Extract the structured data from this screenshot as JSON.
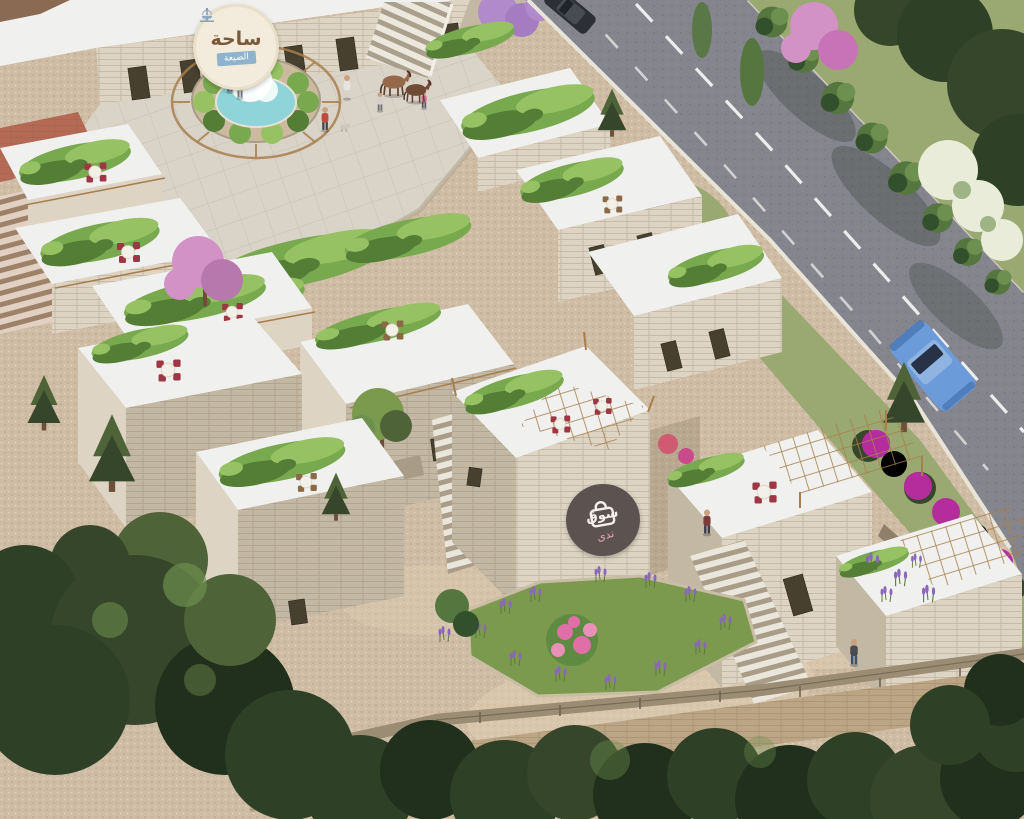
{
  "scene": {
    "type": "aerial-3d-architectural-render",
    "setting": "Hillside stone souk village: limestone shop cubes with rooftop vine pergolas and cafe seating, plaza with fountain, stone stairways, lavender and bougainvillea beds, a two-lane road with hedge and trees, dense forest in the foreground"
  },
  "plaza_sign": {
    "icon": "fountain-icon",
    "title": "ساحة",
    "subtitle": "الضيعة"
  },
  "souq_logo": {
    "icon": "shopping-bag-icon",
    "title": "سوق",
    "subtitle": "ندى"
  },
  "objects": {
    "vehicles": [
      "dark sedan on road (top)",
      "blue car on road (middle)"
    ],
    "animals": [
      "brown horse",
      "dark pony",
      "small dog"
    ],
    "pedestrian_count": 8,
    "rooftop_tables": 8
  },
  "palette": {
    "gravel": "#cfbca4",
    "gravel_light": "#e4d4b9",
    "plaza": "#d9d3c8",
    "brick": "#b56a55",
    "wall": "#ddd4c3",
    "wall_shade": "#c3b8a4",
    "wall_dark": "#a89c87",
    "roof": "#f0f1ee",
    "roof_shade": "#d9dbd7",
    "wood": "#a77f4e",
    "vine": "#79a94f",
    "vine_light": "#96c263",
    "vine_dark": "#547d36",
    "road": "#85858d",
    "lane": "#f2f2f0",
    "verge": "#9aa871",
    "grass": "#7c9a4e",
    "bush": "#55763f",
    "bush_dark": "#33502c",
    "tree_olive": "#4e6337",
    "tree_dark": "#35462b",
    "forest": "#2e4026",
    "forest_dark": "#20301c",
    "flower_pink": "#d292c6",
    "flower_magenta": "#b52d9c",
    "flower_white": "#e9ecd9",
    "lavender": "#8a67b8",
    "rose_pink": "#e06fa8",
    "pool": "#8fd4d8",
    "sign_bg": "#f3ecdc",
    "sign_text": "#7b5a39",
    "sign_ribbon": "#8fb3cc",
    "logo_bg": "#5c5350",
    "logo_text": "#f5f1ea",
    "logo_accent": "#e8a7bd",
    "chair_red": "#9e3644",
    "chair_wood": "#8a6a46",
    "car_blue": "#6b9bd8",
    "car_dark": "#2c2f35",
    "skin": "#caa07e",
    "fence": "#9b8c74"
  }
}
